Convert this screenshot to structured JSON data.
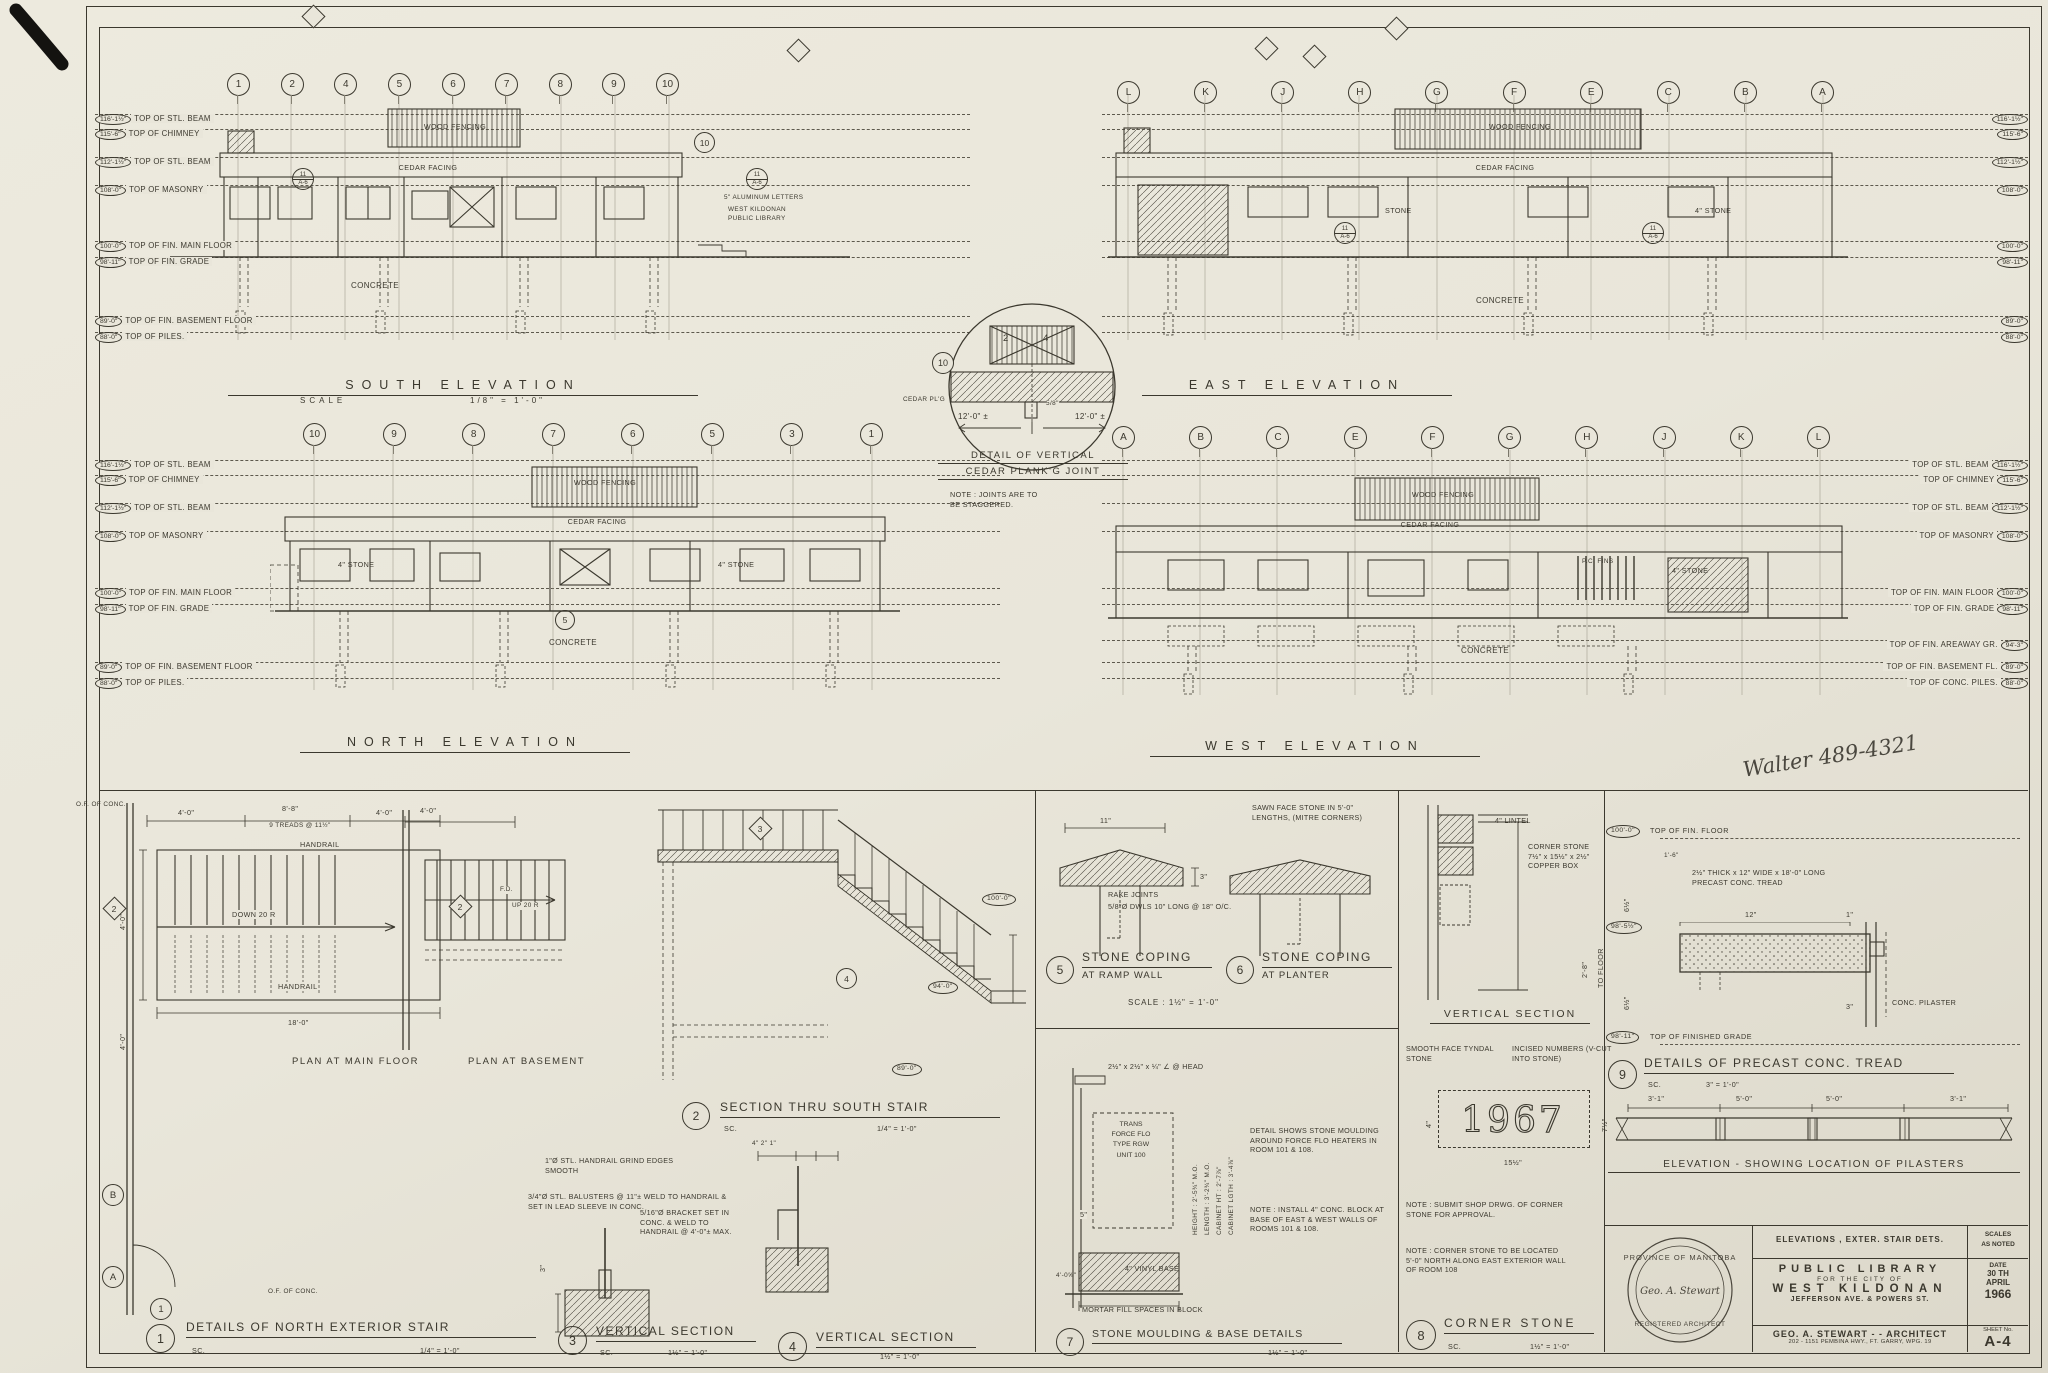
{
  "page": {
    "note": "Walter 489-4321"
  },
  "grid": {
    "south": [
      "1",
      "2",
      "4",
      "5",
      "6",
      "7",
      "8",
      "9",
      "10"
    ],
    "east": [
      "L",
      "K",
      "J",
      "H",
      "G",
      "F",
      "E",
      "C",
      "B",
      "A"
    ],
    "north": [
      "10",
      "9",
      "8",
      "7",
      "6",
      "5",
      "3",
      "1"
    ],
    "west": [
      "A",
      "B",
      "C",
      "E",
      "F",
      "G",
      "H",
      "J",
      "K",
      "L"
    ]
  },
  "levels": {
    "south_left": [
      {
        "v": "116'-1½\"",
        "t": "TOP OF STL. BEAM"
      },
      {
        "v": "115'-6\"",
        "t": "TOP OF CHIMNEY"
      },
      {
        "v": "112'-1½\"",
        "t": "TOP OF STL. BEAM"
      },
      {
        "v": "108'-0\"",
        "t": "TOP OF MASONRY"
      },
      {
        "v": "100'-0\"",
        "t": "TOP OF FIN. MAIN FLOOR"
      },
      {
        "v": "98'-11\"",
        "t": "TOP OF FIN. GRADE"
      },
      {
        "v": "89'-0\"",
        "t": "TOP OF FIN. BASEMENT FLOOR"
      },
      {
        "v": "88'-0\"",
        "t": "TOP OF PILES."
      }
    ],
    "north_left": [
      {
        "v": "116'-1½\"",
        "t": "TOP OF STL. BEAM"
      },
      {
        "v": "115'-6\"",
        "t": "TOP OF CHIMNEY"
      },
      {
        "v": "112'-1½\"",
        "t": "TOP OF STL. BEAM"
      },
      {
        "v": "108'-0\"",
        "t": "TOP OF MASONRY"
      },
      {
        "v": "100'-0\"",
        "t": "TOP OF FIN. MAIN FLOOR"
      },
      {
        "v": "98'-11\"",
        "t": "TOP OF FIN. GRADE"
      },
      {
        "v": "89'-0\"",
        "t": "TOP OF FIN. BASEMENT FLOOR"
      },
      {
        "v": "88'-0\"",
        "t": "TOP OF PILES."
      }
    ],
    "east_right": [
      "116'-1½\"",
      "115'-6\"",
      "112'-1½\"",
      "108'-0\"",
      "100'-0\"",
      "98'-11\"",
      "89'-0\"",
      "88'-0\""
    ],
    "west_right": [
      {
        "t": "TOP OF STL. BEAM",
        "v": "116'-1½\""
      },
      {
        "t": "TOP OF CHIMNEY",
        "v": "115'-6\""
      },
      {
        "t": "TOP OF STL. BEAM",
        "v": "112'-1½\""
      },
      {
        "t": "TOP OF MASONRY",
        "v": "108'-0\""
      },
      {
        "t": "TOP OF FIN. MAIN FLOOR",
        "v": "100'-0\""
      },
      {
        "t": "TOP OF FIN. GRADE",
        "v": "98'-11\""
      },
      {
        "t": "TOP OF FIN. AREAWAY GR.",
        "v": "94'-3\""
      },
      {
        "t": "TOP OF FIN. BASEMENT FL.",
        "v": "89'-0\""
      },
      {
        "t": "TOP OF CONC. PILES.",
        "v": "88'-0\""
      }
    ]
  },
  "elev": {
    "south": {
      "title": "SOUTH ELEVATION",
      "scale_label": "SCALE",
      "scale_value": "1/8\" = 1'-0\"",
      "wood": "WOOD FENCING",
      "cedar": "CEDAR FACING",
      "concrete": "CONCRETE",
      "alum": "5\" ALUMINUM LETTERS",
      "lib1": "WEST KILDONAN",
      "lib2": "PUBLIC LIBRARY",
      "m10": "10",
      "m11": "11",
      "ma6": "A-6"
    },
    "east": {
      "title": "EAST ELEVATION",
      "wood": "WOOD FENCING",
      "cedar": "CEDAR FACING",
      "stone": "STONE",
      "stone4": "4\" STONE",
      "concrete": "CONCRETE",
      "m11": "11",
      "ma6": "A-6"
    },
    "north": {
      "title": "NORTH ELEVATION",
      "wood": "WOOD FENCING",
      "cedar": "CEDAR FACING",
      "stone4l": "4\" STONE",
      "stone4r": "4\" STONE",
      "concrete": "CONCRETE",
      "m5": "5"
    },
    "west": {
      "title": "WEST ELEVATION",
      "wood": "WOOD FENCING",
      "cedar": "CEDAR FACING",
      "pcfins": "P.C. FINS",
      "stone4": "4\" STONE",
      "concrete": "CONCRETE"
    }
  },
  "plank": {
    "m10": "10",
    "n2": "2",
    "n4": "4",
    "dl": "12'-0\" ±",
    "dr": "12'-0\" ±",
    "ds": "5/8\"",
    "side": "CEDAR PL'G",
    "t1": "DETAIL OF VERTICAL",
    "t2": "CEDAR PLANK'G JOINT",
    "note1": "NOTE : JOINTS ARE TO",
    "note2": "BE STAGGERED."
  },
  "stair": {
    "ofc1": "O.F. OF CONC.",
    "ofc2": "O.F. OF CONC.",
    "d40a": "4'-0\"",
    "d88": "8'-8\"",
    "d40b": "4'-0\"",
    "tr": "9 TREADS @ 11½\"",
    "hr1": "HANDRAIL",
    "dn": "DOWN 20 R",
    "hr2": "HANDRAIL",
    "d18": "18'-0\"",
    "d40c": "4'-0\"",
    "d40d": "4'-0\"",
    "pm": "PLAN AT MAIN FLOOR",
    "pb": "PLAN AT BASEMENT",
    "d40e": "4'-0\"",
    "fd": "F.D.",
    "up": "UP 20 R",
    "b2": "2",
    "bB": "B",
    "bA": "A",
    "b1": "1",
    "nh": "1\"Ø STL. HANDRAIL GRIND EDGES SMOOTH",
    "nb": "3/4\"Ø STL. BALUSTERS @ 11\"± WELD TO HANDRAIL & SET IN LEAD SLEEVE IN CONC.",
    "nk": "5/16\"Ø BRACKET SET IN CONC. & WELD TO HANDRAIL @ 4'-0\"± MAX.",
    "d3": "3\"",
    "dsm": "4\"  2\"  1\"",
    "sec3": "3",
    "sec4": "4",
    "lvA": "100'-0\"",
    "lvB": "94'-0\"",
    "lvC": "89'-0\"",
    "t1n": "1",
    "t1": "DETAILS OF NORTH EXTERIOR STAIR",
    "t1sc": "SC.",
    "t1s": "1/4\" = 1'-0\"",
    "t2n": "2",
    "t2": "SECTION THRU SOUTH STAIR",
    "t2sc": "SC.",
    "t2s": "1/4\" = 1'-0\"",
    "t3n": "3",
    "t3": "VERTICAL SECTION",
    "t3sc": "SC.",
    "t3s": "1½\" = 1'-0\"",
    "t4n": "4",
    "t4": "VERTICAL SECTION",
    "t4s": "1½\" = 1'-0\""
  },
  "coping": {
    "ns": "SAWN FACE STONE IN 5'-0\" LENGTHS, (MITRE CORNERS)",
    "nr": "RAKE JOINTS",
    "nd": "5/8\"Ø DWLS 10\" LONG @ 18\" O/C.",
    "d11": "11\"",
    "d3": "3\"",
    "n5": "5",
    "t5a": "STONE COPING",
    "t5b": "AT RAMP WALL",
    "n6": "6",
    "t6a": "STONE COPING",
    "t6b": "AT PLANTER",
    "sc": "SCALE : 1½\" = 1'-0\""
  },
  "moulding": {
    "head": "2½\" x 2½\" x ¼\" ∠ @ HEAD",
    "unit": [
      "TRANS",
      "FORCE FLO",
      "TYPE RGW",
      "UNIT 100"
    ],
    "vdims": [
      "HEIGHT : 2'-5¾\" M.O.",
      "LENGTH : 3'-2¾\" M.O.",
      "CABINET HT : 2'-7⅞\"",
      "CABINET LGTH : 3'-4⅞\""
    ],
    "note1": "DETAIL SHOWS STONE MOULDING AROUND FORCE FLO HEATERS IN ROOM 101 & 108.",
    "note2": "NOTE : INSTALL 4\" CONC. BLOCK AT BASE OF EAST & WEST WALLS OF ROOMS 101 & 108.",
    "d5": "5\"",
    "dbase": "4'-0⅝\"",
    "vinyl": "4\" VINYL BASE",
    "mortar": "MORTAR FILL SPACES IN BLOCK",
    "n7": "7",
    "t7": "STONE MOULDING & BASE DETAILS",
    "t7s": "1½\" = 1'-0\""
  },
  "corner": {
    "lintel": "4\" LINTEL",
    "cs1": "CORNER STONE",
    "cs2": "7½\" x 15½\" x 2½\"",
    "cs3": "COPPER BOX",
    "tofloor": "TO FLOOR",
    "d28": "2'-8\"",
    "vs": "VERTICAL SECTION",
    "smooth": "SMOOTH FACE TYNDAL STONE",
    "incised": "INCISED NUMBERS (V-CUT INTO STONE)",
    "year": "1967",
    "d4": "4\"",
    "d75": "7½\"",
    "d155": "15½\"",
    "n1": "NOTE : SUBMIT SHOP DRWG. OF CORNER STONE FOR APPROVAL.",
    "n2": "NOTE : CORNER STONE TO BE LOCATED 5'-0\" NORTH ALONG EAST EXTERIOR WALL OF ROOM 108",
    "n8": "8",
    "t8": "CORNER STONE",
    "t8sc": "SC.",
    "t8s": "1½\" = 1'-0\""
  },
  "tread": {
    "lvf": "100'-0\"",
    "lvft": "TOP OF FIN. FLOOR",
    "lvm": "98'-5½\"",
    "lvg": "98'-11\"",
    "lvgt": "TOP OF FINISHED GRADE",
    "note": "2½\" THICK x 12\" WIDE x 18'-0\" LONG PRECAST CONC. TREAD",
    "d65a": "6½\"",
    "d65b": "6½\"",
    "d12": "12\"",
    "d1": "1\"",
    "d3": "3\"",
    "d16": "1'-6\"",
    "pilaster": "CONC. PILASTER",
    "n9": "9",
    "t9": "DETAILS OF PRECAST CONC. TREAD",
    "t9sc": "SC.",
    "t9s": "3\" = 1'-0\"",
    "elev_dims": [
      "3'-1\"",
      "5'-0\"",
      "5'-0\"",
      "3'-1\""
    ],
    "et": "ELEVATION - SHOWING LOCATION OF PILASTERS"
  },
  "tb": {
    "r1": "ELEVATIONS , EXTER. STAIR DETS.",
    "scales1": "SCALES",
    "scales2": "AS NOTED",
    "p1": "PUBLIC LIBRARY",
    "p2": "FOR THE CITY OF",
    "p3": "WEST KILDONAN",
    "p4": "JEFFERSON AVE. & POWERS ST.",
    "datel": "DATE",
    "date1": "30 TH",
    "date2": "APRIL",
    "date3": "1966",
    "a1": "GEO. A. STEWART - - ARCHITECT",
    "a2": "202 - 1151 PEMBINA HWY., FT. GARRY, WPG. 19",
    "sheetl": "SHEET No.",
    "sheet": "A-4"
  },
  "seal": {
    "top": "PROVINCE OF MANITOBA",
    "bottom": "REGISTERED ARCHITECT",
    "center": "Geo. A. Stewart"
  },
  "colors": {
    "ink": "#3b382e",
    "paper": "#e9e6da"
  }
}
